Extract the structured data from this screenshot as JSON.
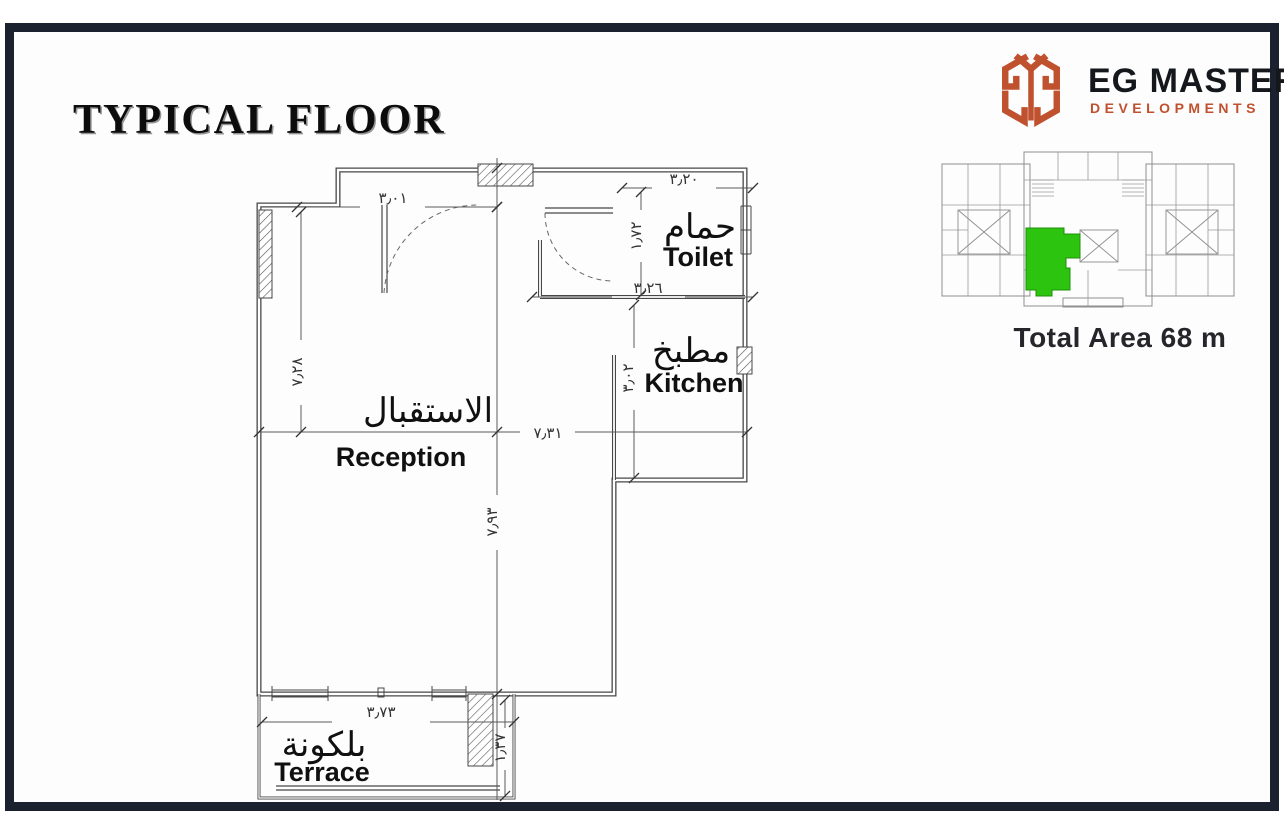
{
  "frame": {
    "border_color": "#1c2130"
  },
  "header": {
    "title": "TYPICAL FLOOR"
  },
  "brand": {
    "name": "EG MASTER",
    "subtitle": "DEVELOPMENTS",
    "logo_color": "#c0512f"
  },
  "key_plan": {
    "total_area": "Total Area 68 m",
    "highlight_color": "#2cc40e",
    "line_color": "#8e8e8e"
  },
  "floor_plan": {
    "rooms": {
      "reception": {
        "ar": "الاستقبال",
        "en": "Reception"
      },
      "toilet": {
        "ar": "حمام",
        "en": "Toilet"
      },
      "kitchen": {
        "ar": "مطبخ",
        "en": "Kitchen"
      },
      "terrace": {
        "ar": "بلكونة",
        "en": "Terrace"
      }
    },
    "dimensions": {
      "entry_width": "٣٫٠١",
      "toilet_width": "٣٫٢٠",
      "toilet_depth": "١٫٧٢",
      "kitchen_width": "٣٫٢٦",
      "kitchen_depth": "٣٫٠٢",
      "reception_depth": "٧٫٢٨",
      "reception_width": "٧٫٣١",
      "overall_depth": "٧٫٩٣",
      "terrace_width": "٣٫٧٣",
      "terrace_depth": "١٫٣٧"
    }
  }
}
